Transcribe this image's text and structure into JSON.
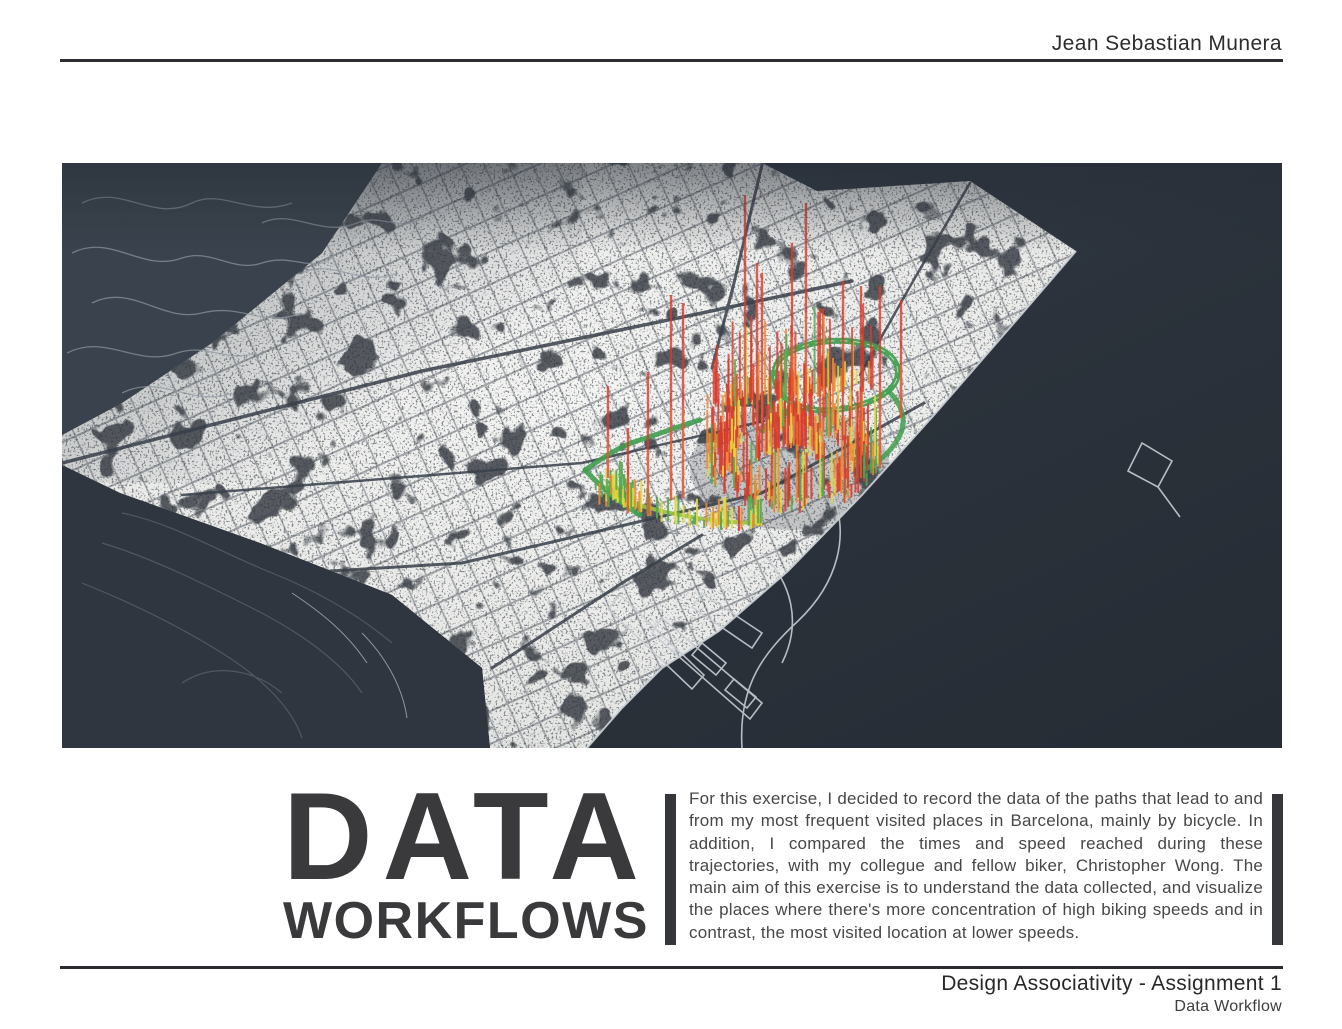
{
  "header": {
    "author": "Jean Sebastian Munera"
  },
  "title": {
    "line1": "DATA",
    "line2": "WORKFLOWS"
  },
  "description": "For this exercise, I decided to record the data of the paths that lead to and from my most frequent visited places in Barcelona, mainly by bicycle. In addition, I compared the times and speed reached during these trajectories, with my collegue and fellow biker, Christopher Wong. The main aim of this exercise is to understand the data collected, and visualize the places where there's more concentration of high biking speeds and in contrast, the most visited location at lower speeds.",
  "footer": {
    "course": "Design Associativity - Assignment 1",
    "subtitle": "Data Workflow"
  },
  "map": {
    "name": "barcelona-bike-data-map",
    "alt": "Aerial perspective map of Barcelona with 3D colored bars showing concentration of biking speeds along recorded routes",
    "colors": {
      "sea": "#2b323b",
      "hills": "#3a434d",
      "city": "#eeefee",
      "street": "#424a54",
      "route_green": "#3f9e4f",
      "bar_green": "#55a84e",
      "bar_yellow": "#e2d83e",
      "bar_orange": "#ef8833",
      "bar_red": "#d93a2b"
    }
  }
}
